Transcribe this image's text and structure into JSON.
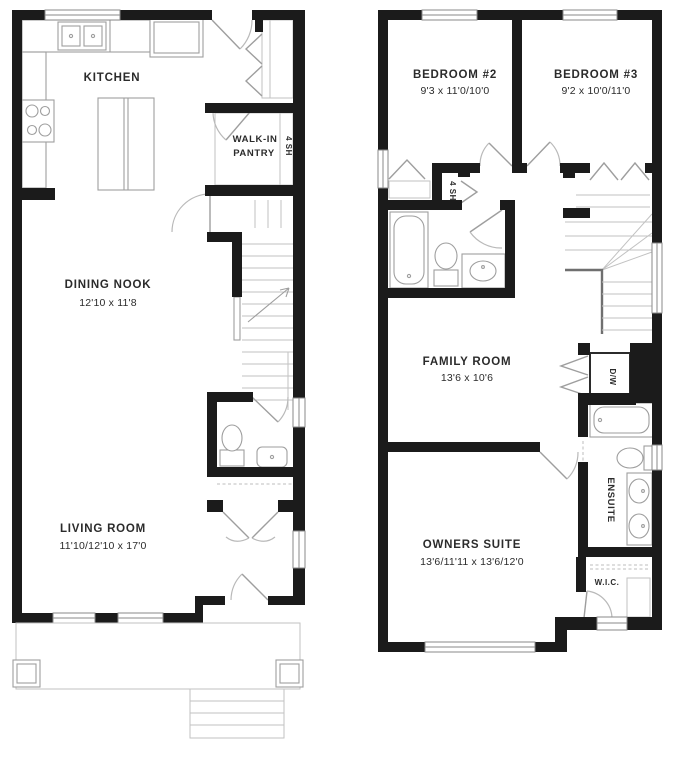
{
  "colors": {
    "wall": "#1b1b1b",
    "fixture_line": "#9e9e9e",
    "light_line": "#c2c2c2",
    "text": "#2b2b2b",
    "background": "#ffffff"
  },
  "floor1": {
    "kitchen_label": "KITCHEN",
    "pantry_line1": "WALK-IN",
    "pantry_line2": "PANTRY",
    "pantry_shelves": "4 SH",
    "dining_label": "DINING NOOK",
    "dining_dims": "12'10 x 11'8",
    "living_label": "LIVING ROOM",
    "living_dims": "11'10/12'10 x 17'0"
  },
  "floor2": {
    "bedroom2_label": "BEDROOM #2",
    "bedroom2_dims": "9'3 x 11'0/10'0",
    "bedroom3_label": "BEDROOM #3",
    "bedroom3_dims": "9'2 x 10'0/11'0",
    "linen_shelves": "4 SH",
    "family_label": "FAMILY ROOM",
    "family_dims": "13'6 x 10'6",
    "owners_label": "OWNERS SUITE",
    "owners_dims": "13'6/11'11 x 13'6/12'0",
    "ensuite_label": "ENSUITE",
    "wic_label": "W.I.C.",
    "dw_label": "D/W"
  }
}
